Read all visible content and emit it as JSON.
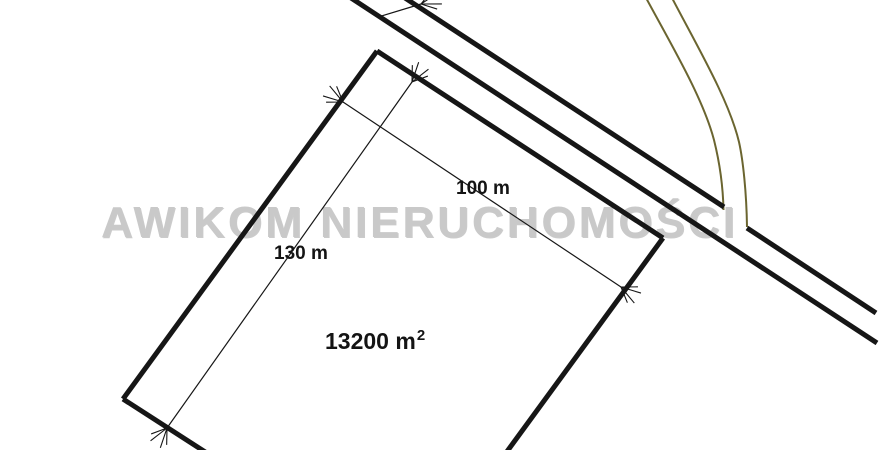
{
  "plan": {
    "watermark": {
      "text": "AWIKOM NIERUCHOMOŚCI",
      "color": "#c9c9c9"
    },
    "labels": {
      "width": {
        "text": "100 m"
      },
      "length": {
        "text": "130 m"
      },
      "area": {
        "text": "13200 m",
        "sup": "2"
      }
    },
    "colors": {
      "line": "#161616",
      "track": "#6b6530"
    },
    "solid_lines": [
      {
        "name": "road-north-edge-segment-1",
        "x1": 402,
        "y1": -4,
        "x2": 724,
        "y2": 207
      },
      {
        "name": "road-north-edge-segment-2",
        "x1": 747,
        "y1": 228,
        "x2": 876,
        "y2": 313
      },
      {
        "name": "road-south-edge",
        "x1": 348,
        "y1": -4,
        "x2": 877,
        "y2": 343
      },
      {
        "name": "plot-top-edge",
        "x1": 377,
        "y1": 51,
        "x2": 663,
        "y2": 238
      },
      {
        "name": "plot-left-edge",
        "x1": 377,
        "y1": 51,
        "x2": 123,
        "y2": 399
      },
      {
        "name": "plot-bottom-edge",
        "x1": 123,
        "y1": 399,
        "x2": 213,
        "y2": 457
      },
      {
        "name": "plot-right-edge",
        "x1": 663,
        "y1": 238,
        "x2": 503,
        "y2": 457
      }
    ],
    "track_lines": [
      {
        "name": "track-west-line",
        "d": "M 645,-4 C 672,46 703,98 714,140 C 719,160 723,186 723.5,210"
      },
      {
        "name": "track-east-line",
        "d": "M 671,-4 C 697,46 729,100 739,142 C 743,160 746.5,192 747,227"
      }
    ],
    "dimensions": [
      {
        "name": "length-dimension-line",
        "x1": 412,
        "y1": 82,
        "x2": 167,
        "y2": 428,
        "arrows": "both"
      },
      {
        "name": "width-dimension-line",
        "x1": 343,
        "y1": 102,
        "x2": 621,
        "y2": 287,
        "arrows": "both"
      },
      {
        "name": "cropped-dimension-arrow-top",
        "x1": 378,
        "y1": 17,
        "x2": 421,
        "y2": 4,
        "arrows": "end"
      }
    ]
  }
}
